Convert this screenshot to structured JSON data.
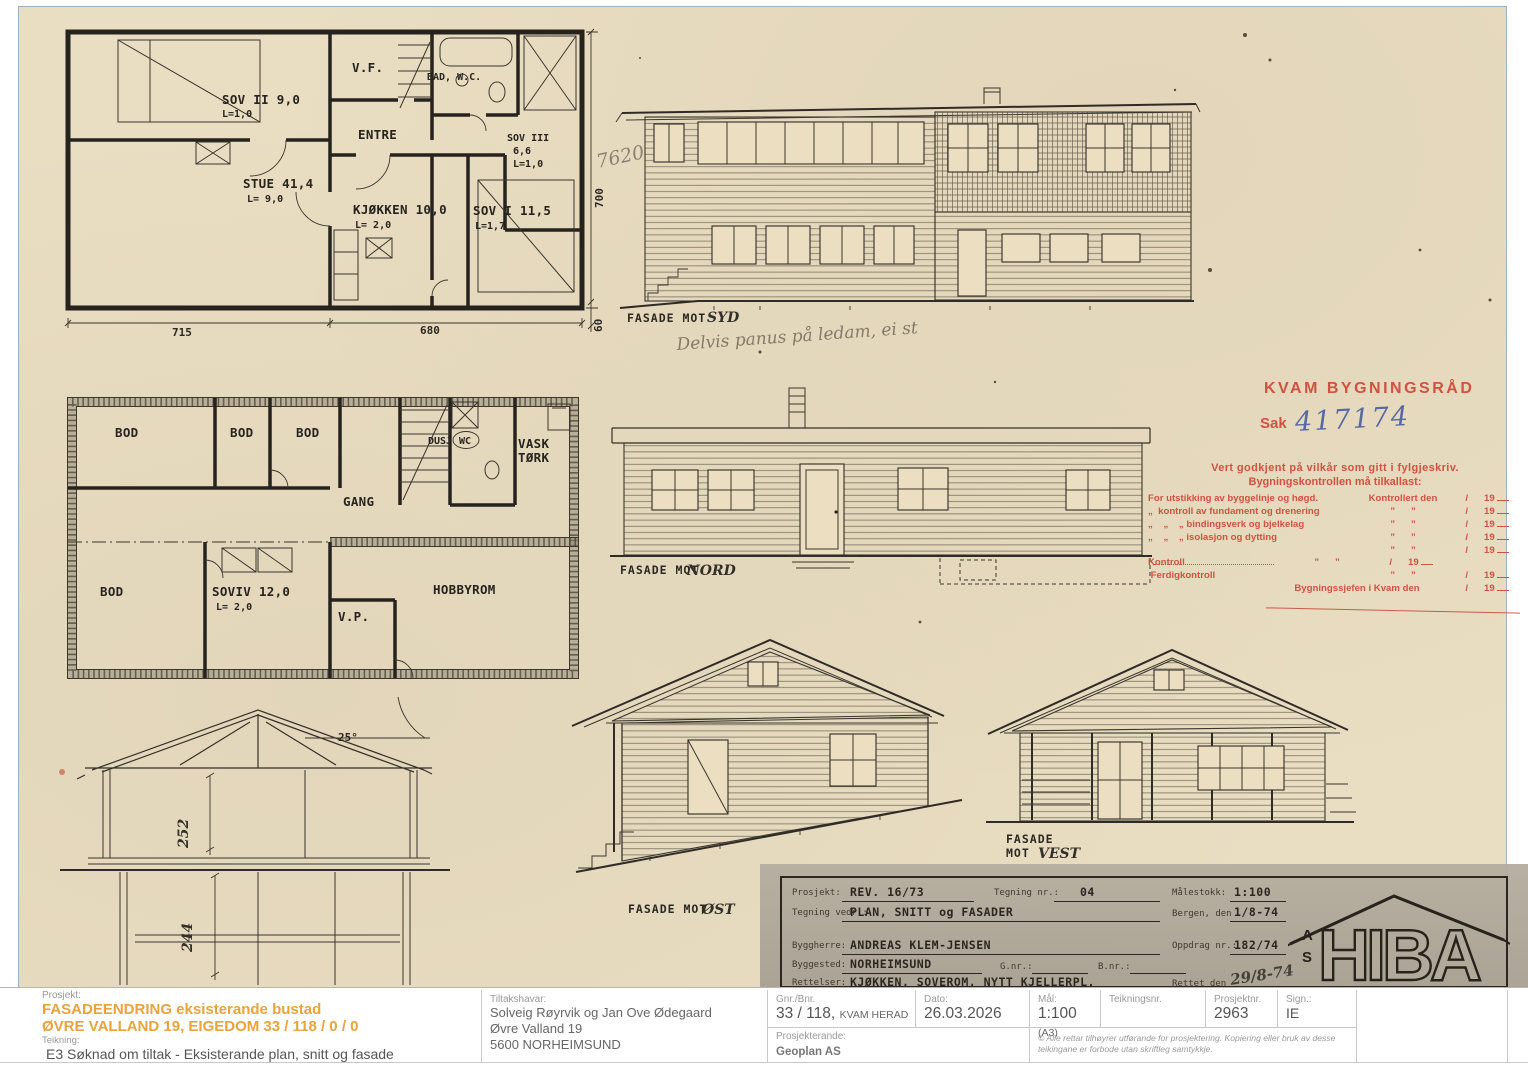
{
  "scan": {
    "plan1": {
      "sov2": "SOV II 9,0",
      "sov2_l": "L=1,0",
      "vf": "V.F.",
      "bad": "BAD, W.C.",
      "entre": "ENTRE",
      "sov3": "SOV III",
      "sov3_area": "6,6",
      "sov3_l": "L=1,0",
      "stue": "STUE 41,4",
      "stue_l": "L= 9,0",
      "kjokken": "KJØKKEN 10,0",
      "kjokken_l": "L= 2,0",
      "sov1": "SOV I 11,5",
      "sov1_l": "L=1,7",
      "dim_715": "715",
      "dim_680": "680",
      "dim_700": "700",
      "dim_60": "60"
    },
    "plan2": {
      "bod1": "BOD",
      "bod2": "BOD",
      "bod3": "BOD",
      "bod4": "BOD",
      "dusj": "DUSJ",
      "wc": "WC",
      "vask": "VASK",
      "tork": "TØRK",
      "gang": "GANG",
      "sov4": "SOVIV 12,0",
      "sov4_l": "L= 2,0",
      "vp": "V.P.",
      "hobby": "HOBBYROM"
    },
    "section": {
      "angle": "25°",
      "h_upper": "252",
      "h_lower": "244"
    },
    "facades": {
      "prefix": "FASADE MOT",
      "syd": "SYD",
      "nord": "NORD",
      "ost": "ØST",
      "vest_line1": "FASADE",
      "vest_line2": "MOT",
      "vest": "VEST",
      "pencil_note": "Delvis panus på ledam, ei st",
      "pencil_mark": "7620"
    },
    "stamp": {
      "title": "KVAM BYGNINGSRÅD",
      "sak_label": "Sak",
      "sak_number": "417174",
      "line1": "Vert godkjent på vilkår som gitt i fylgjeskriv.",
      "line2": "Bygningskontrollen må tilkallast:",
      "rows": [
        {
          "left": "For utstikking av byggelinje og høgd.",
          "mid": "Kontrollert den",
          "slash": "/",
          "year": "19"
        },
        {
          "left": "„  kontroll av fundament og drenering",
          "mid": "”      ”",
          "slash": "/",
          "year": "19"
        },
        {
          "left": "„    „    „ bindingsverk og bjelkelag",
          "mid": "”      ”",
          "slash": "/",
          "year": "19"
        },
        {
          "left": "„    „    „ isolasjon og dytting",
          "mid": "”      ”",
          "slash": "/",
          "year": "19"
        },
        {
          "left": "",
          "mid": "”      ”",
          "slash": "/",
          "year": "19"
        },
        {
          "left": "Kontroll",
          "mid": "”      ”",
          "slash": "/",
          "year": "19"
        },
        {
          "left": " Ferdigkontroll",
          "mid": "”      ”",
          "slash": "/",
          "year": "19"
        },
        {
          "left": "",
          "mid": "Bygningssjefen i Kvam den",
          "slash": "/",
          "year": "19"
        }
      ]
    },
    "titleblock": {
      "prosjekt_label": "Prosjekt:",
      "prosjekt_value": "REV. 16/73",
      "tegning_nr_label": "Tegning nr.:",
      "tegning_nr_value": "04",
      "malestokk_label": "Målestokk:",
      "malestokk_value": "1:100",
      "tegning_vedr_label": "Tegning vedr.:",
      "tegning_vedr_value": "PLAN, SNITT og FASADER",
      "bergen_label": "Bergen, den",
      "bergen_value": "1/8-74",
      "byggherre_label": "Byggherre:",
      "byggherre_value": "ANDREAS KLEM-JENSEN",
      "oppdrag_label": "Oppdrag nr.:",
      "oppdrag_value": "182/74",
      "byggested_label": "Byggested:",
      "byggested_value": "NORHEIMSUND",
      "gnr_label": "G.nr.:",
      "bnr_label": "B.nr.:",
      "rettelser_label": "Rettelser:",
      "rettelser_value": "KJØKKEN, SOVEROM, NYTT KJELLERPL.",
      "rettet_label": "Rettet den",
      "rettet_value": "29/8-74",
      "logo": "HIBA",
      "logo_as_top": "A",
      "logo_as_bottom": "S"
    }
  },
  "footer": {
    "prosjekt_label": "Prosjekt:",
    "prosjekt_line1": "FASADEENDRING eksisterande bustad",
    "prosjekt_line2": "ØVRE VALLAND 19, EIGEDOM 33 / 118 / 0 / 0",
    "teikning_label": "Teikning:",
    "teikning_value": "E3 Søknad om tiltak - Eksisterande plan, snitt og fasade",
    "tiltakshavar_label": "Tiltakshavar:",
    "tiltakshavar_line1": "Solveig Røyrvik og Jan Ove Ødegaard",
    "tiltakshavar_line2": "Øvre Valland 19",
    "tiltakshavar_line3": "5600 NORHEIMSUND",
    "gnr_label": "Gnr./Bnr.",
    "gnr_value": "33 / 118,",
    "gnr_area": "KVAM HERAD",
    "dato_label": "Dato:",
    "dato_value": "26.03.2026",
    "mal_label": "Mål:",
    "mal_value": "1:100",
    "mal_format": "(A3)",
    "teikningsnr_label": "Teikningsnr.",
    "prosjektnr_label": "Prosjektnr.",
    "prosjektnr_value": "2963",
    "sign_label": "Sign.:",
    "sign_value": "IE",
    "prosjekterande_label": "Prosjekterande:",
    "prosjekterande_value": "Geoplan AS",
    "copyright": "© Alle rettar tilhøyrer utførande for prosjektering. Kopiering eller bruk av desse teikingane er forbode utan skriftleg samtykkje."
  },
  "colors": {
    "accent_orange": "#E8A33C",
    "stamp_red": "#CF4736",
    "handwriting_blue": "#4A5FA5",
    "paper": "#E9DDC2"
  }
}
